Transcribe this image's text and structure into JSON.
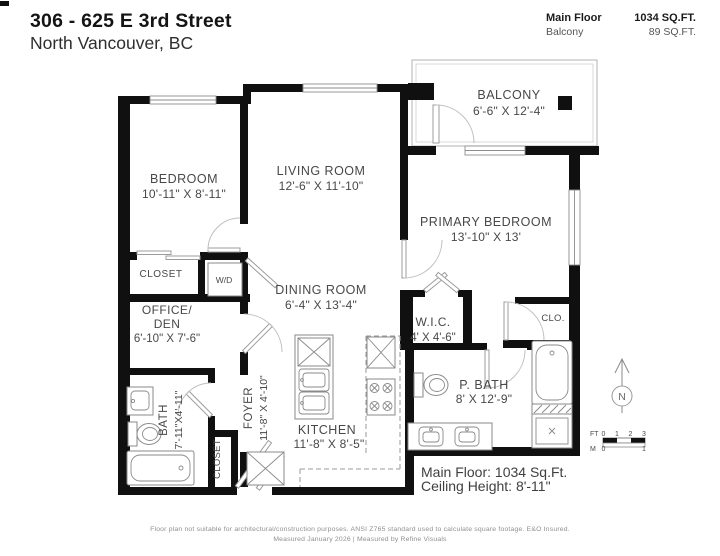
{
  "header": {
    "title": "306 - 625 E 3rd Street",
    "subtitle": "North Vancouver, BC"
  },
  "legend": {
    "rows": [
      {
        "label": "Main Floor",
        "value": "1034 SQ.FT."
      },
      {
        "label": "Balcony",
        "value": "89 SQ.FT."
      }
    ]
  },
  "rooms": {
    "balcony": {
      "name": "BALCONY",
      "dims": "6'-6\" X 12'-4\""
    },
    "bedroom": {
      "name": "BEDROOM",
      "dims": "10'-11\" X 8'-11\""
    },
    "living_room": {
      "name": "LIVING ROOM",
      "dims": "12'-6\" X 11'-10\""
    },
    "primary_bedroom": {
      "name": "PRIMARY BEDROOM",
      "dims": "13'-10\" X 13'"
    },
    "closet": {
      "name": "CLOSET"
    },
    "laundry": {
      "name": "W/D"
    },
    "office_den": {
      "line1": "OFFICE/",
      "line2": "DEN",
      "dims": "6'-10\" X 7'-6\""
    },
    "dining_room": {
      "name": "DINING ROOM",
      "dims": "6'-4\" X 13'-4\""
    },
    "wic": {
      "name": "W.I.C.",
      "dims": "4' X 4'-6\""
    },
    "clo": {
      "name": "CLO."
    },
    "bath": {
      "name": "BATH",
      "dims": "7'-11\"X4'-11\""
    },
    "foyer": {
      "name": "FOYER",
      "dims": "11'-8\" X 4'-10\""
    },
    "foyer_closet": {
      "name": "CLOSET"
    },
    "kitchen": {
      "name": "KITCHEN",
      "dims": "11'-8\" X 8'-5\""
    },
    "p_bath": {
      "name": "P. BATH",
      "dims": "8' X 12'-9\""
    }
  },
  "summary": {
    "line1": "Main Floor: 1034 Sq.Ft.",
    "line2": "Ceiling Height: 8'-11\""
  },
  "compass": {
    "letter": "N"
  },
  "scale_bar": {
    "ft_label": "FT",
    "m_label": "M",
    "ft_ticks": [
      "0",
      "1",
      "2",
      "3"
    ],
    "m_ticks": [
      "0",
      "1"
    ]
  },
  "footer": {
    "line1": "Floor plan not suitable for architectural/construction purposes. ANSI Z765 standard used to calculate square footage. E&O Insured.",
    "line2": "Measured January 2026 | Measured by Refine Visuals"
  },
  "colors": {
    "wall": "#101010",
    "label": "#484848",
    "fixture_line": "#8a8a8a"
  }
}
